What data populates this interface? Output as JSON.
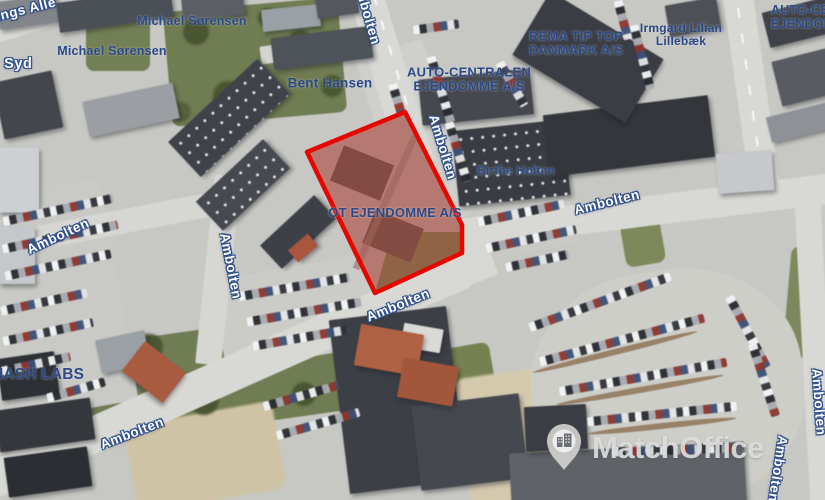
{
  "watermark": {
    "brand": "MatchOffice"
  },
  "map": {
    "colors": {
      "company_label": "#2c4985",
      "street_label_fill": "#ffffff",
      "street_label_outline": "#32518c",
      "highlight_red": "#e60600"
    },
    "highlighted_property": "OT EJENDOMME A/S",
    "company_labels": [
      {
        "text": "Michael Sørensen"
      },
      {
        "text": "Michael Sørensen"
      },
      {
        "text": "Bent Hansen"
      },
      {
        "lines": [
          "AUTO-CENTRALEN",
          "EJENDOMME A/S"
        ]
      },
      {
        "lines": [
          "REMA TIP TOP",
          "DANMARK A/S"
        ]
      },
      {
        "lines": [
          "Irmgard Lilian",
          "Lillebæk"
        ]
      },
      {
        "text": "Birthe Holten"
      },
      {
        "text": "OT EJENDOMME A/S"
      },
      {
        "text": "NASH LABS"
      },
      {
        "lines": [
          "AUTO-CENTRALEN",
          "EJENDOMME A/S"
        ]
      }
    ],
    "streets": {
      "ambolten": "Ambolten",
      "alle_partial": "ings Allé",
      "syd_partial": "g Syd"
    }
  }
}
